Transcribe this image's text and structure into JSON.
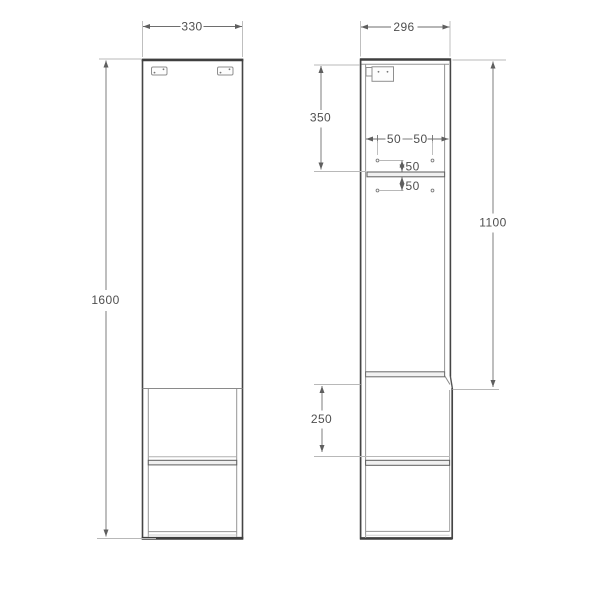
{
  "drawing": {
    "type": "furniture-technical-drawing",
    "subject": "tall-side-cabinet-two-views",
    "front": {
      "width": "330",
      "height": "1600"
    },
    "side": {
      "depth": "296",
      "top_section": "350",
      "door_height": "1100",
      "lower_compartment": "250",
      "pin_col_left_inset": "50",
      "pin_col_right_inset": "50",
      "pin_above_shelf": "50",
      "pin_below_shelf": "50"
    }
  },
  "colors": {
    "background": "#ffffff",
    "outline": "#454545",
    "inner_line": "#949494",
    "dimension_line": "#6e6e6e",
    "extension_line": "#b8b8b8",
    "text": "#4f4f4f",
    "shelf_fill": "#f0f0f0"
  }
}
